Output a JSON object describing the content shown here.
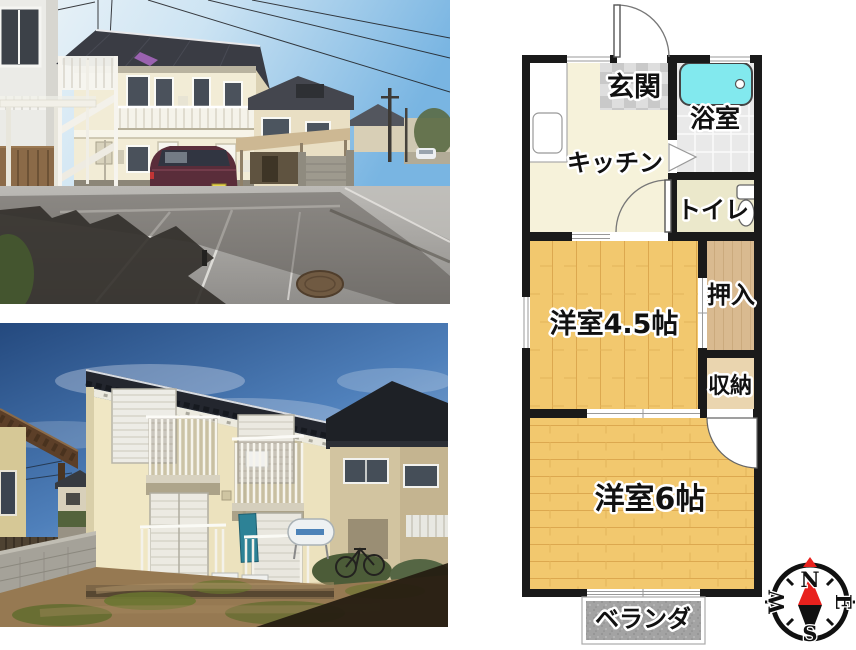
{
  "floorplan": {
    "labels": {
      "genkan": "玄関",
      "bathroom": "浴室",
      "kitchen": "キッチン",
      "toilet": "トイレ",
      "oshiire": "押入",
      "storage": "収納",
      "room45": "洋室4.5帖",
      "room6": "洋室6帖",
      "veranda": "ベランダ"
    },
    "compass": {
      "north": "N",
      "east": "E",
      "south": "S",
      "west": "W"
    },
    "colors": {
      "wall": "#1a1a1a",
      "kitchen_floor": "#f6f2da",
      "genkan_tile_dark": "#c9c9c9",
      "genkan_tile_light": "#dedede",
      "bath_floor": "#e9e9e9",
      "bathtub": "#82e9ee",
      "toilet_floor": "#ebe8cb",
      "wood_floor": "#f2c86e",
      "wood_plank_line": "#dca84f",
      "oshiire": "#d9ba90",
      "storage": "#ead5af",
      "veranda_gray": "#a3a3a3",
      "needle_red": "#e8211d"
    },
    "icons": [
      "bathtub-icon",
      "toilet-icon",
      "kitchen-sink-icon",
      "door-swing-icon",
      "folding-door-icon",
      "compass-rose-icon"
    ]
  },
  "photos": {
    "top": {
      "name": "exterior-front-street-photo"
    },
    "bottom": {
      "name": "exterior-rear-yard-photo"
    }
  }
}
